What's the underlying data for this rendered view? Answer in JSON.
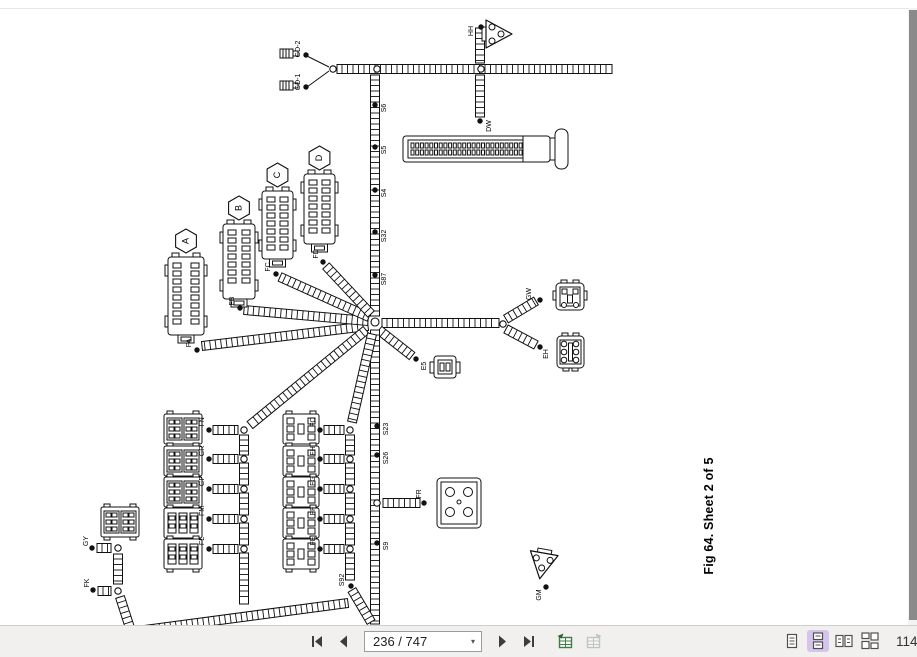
{
  "toolbar": {
    "page_value": "236 / 747",
    "zoom_value": "114",
    "nav_icons": [
      "first-page",
      "previous-page",
      "next-page",
      "last-page"
    ],
    "extra_icons": [
      "previous-view-table",
      "next-view-table"
    ],
    "view_icons": [
      "single-page",
      "continuous",
      "facing",
      "continuous-facing"
    ],
    "active_view": "continuous"
  },
  "diagram": {
    "caption": "Fig 64. Sheet 2 of 5",
    "colors": {
      "line": "#111111",
      "paper": "#ffffff",
      "toolbar_bg": "#f1f0ef",
      "highlight": "#d5c5ec",
      "scrollbar_thumb": "#8a8a8a",
      "icon_green": "#3f7d44"
    },
    "badges": [
      "A",
      "B",
      "C",
      "D"
    ],
    "connector_labels": [
      "HH",
      "DW",
      "GD-2",
      "GD-1",
      "S6",
      "S5",
      "S4",
      "S32",
      "S87",
      "FA",
      "FB",
      "FC",
      "FD",
      "GW",
      "EH",
      "E5",
      "S23",
      "S26",
      "FR",
      "S9",
      "S92",
      "FN",
      "GR",
      "GP",
      "FM",
      "FL",
      "FO",
      "FH",
      "FG",
      "FF",
      "FE",
      "GY",
      "FK",
      "GM"
    ],
    "ladders": [
      [
        337,
        69,
        612,
        69
      ],
      [
        480,
        28,
        480,
        63
      ],
      [
        480,
        75,
        480,
        117
      ],
      [
        375,
        75,
        375,
        316
      ],
      [
        368,
        326,
        202,
        346
      ],
      [
        368,
        321,
        244,
        310
      ],
      [
        369,
        317,
        280,
        277
      ],
      [
        371,
        314,
        326,
        266
      ],
      [
        382,
        323,
        499,
        323
      ],
      [
        506,
        319,
        536,
        301
      ],
      [
        506,
        329,
        536,
        345
      ],
      [
        379,
        330,
        412,
        356
      ],
      [
        375,
        330,
        375,
        624
      ],
      [
        383,
        503,
        420,
        503
      ],
      [
        366,
        330,
        250,
        425
      ],
      [
        372,
        334,
        352,
        422
      ],
      [
        244,
        435,
        244,
        455
      ],
      [
        244,
        463,
        244,
        485
      ],
      [
        244,
        493,
        244,
        515
      ],
      [
        244,
        523,
        244,
        545
      ],
      [
        244,
        553,
        244,
        604
      ],
      [
        350,
        435,
        350,
        455
      ],
      [
        350,
        463,
        350,
        485
      ],
      [
        350,
        493,
        350,
        515
      ],
      [
        350,
        523,
        350,
        545
      ],
      [
        350,
        553,
        350,
        580
      ],
      [
        352,
        590,
        371,
        622
      ],
      [
        213,
        430,
        238,
        430
      ],
      [
        213,
        459,
        238,
        459
      ],
      [
        213,
        489,
        238,
        489
      ],
      [
        213,
        519,
        238,
        519
      ],
      [
        213,
        549,
        238,
        549
      ],
      [
        324,
        430,
        344,
        430
      ],
      [
        324,
        459,
        344,
        459
      ],
      [
        324,
        489,
        344,
        489
      ],
      [
        324,
        519,
        344,
        519
      ],
      [
        324,
        549,
        344,
        549
      ],
      [
        97,
        548,
        111,
        548
      ],
      [
        118,
        554,
        118,
        584
      ],
      [
        98,
        591,
        111,
        591
      ],
      [
        120,
        597,
        130,
        628
      ],
      [
        122,
        633,
        348,
        603
      ]
    ],
    "lines": [
      [
        307,
        56,
        329,
        67
      ],
      [
        307,
        87,
        329,
        71
      ]
    ],
    "junctions": [
      [
        333,
        69
      ],
      [
        377,
        69
      ],
      [
        481,
        69
      ],
      [
        375,
        322,
        4
      ],
      [
        503,
        324
      ],
      [
        377,
        503
      ],
      [
        244,
        430
      ],
      [
        244,
        459
      ],
      [
        244,
        489
      ],
      [
        244,
        519
      ],
      [
        244,
        549
      ],
      [
        350,
        430
      ],
      [
        350,
        459
      ],
      [
        350,
        489
      ],
      [
        350,
        519
      ],
      [
        350,
        549
      ],
      [
        118,
        548
      ],
      [
        118,
        591
      ]
    ],
    "splices": [
      {
        "t": "HH",
        "x": 481,
        "y": 27,
        "lx": 471,
        "ly": 31
      },
      {
        "t": "DW",
        "x": 480,
        "y": 121,
        "lx": 489,
        "ly": 126
      },
      {
        "t": "S6",
        "x": 375,
        "y": 105,
        "lx": 384,
        "ly": 108
      },
      {
        "t": "S5",
        "x": 375,
        "y": 147,
        "lx": 384,
        "ly": 150
      },
      {
        "t": "S4",
        "x": 375,
        "y": 190,
        "lx": 384,
        "ly": 193
      },
      {
        "t": "S32",
        "x": 375,
        "y": 232,
        "lx": 384,
        "ly": 236
      },
      {
        "t": "S87",
        "x": 375,
        "y": 275,
        "lx": 384,
        "ly": 279
      },
      {
        "t": "S23",
        "x": 377,
        "y": 426,
        "lx": 386,
        "ly": 429
      },
      {
        "t": "S26",
        "x": 377,
        "y": 455,
        "lx": 386,
        "ly": 458
      },
      {
        "t": "S9",
        "x": 377,
        "y": 543,
        "lx": 386,
        "ly": 546
      },
      {
        "t": "S92",
        "x": 351,
        "y": 586,
        "lx": 342,
        "ly": 580
      },
      {
        "t": "FR",
        "x": 424,
        "y": 503,
        "lx": 419,
        "ly": 494
      },
      {
        "t": "E5",
        "x": 416,
        "y": 359,
        "lx": 424,
        "ly": 366
      },
      {
        "t": "GW",
        "x": 540,
        "y": 300,
        "lx": 529,
        "ly": 294
      },
      {
        "t": "EH",
        "x": 540,
        "y": 347,
        "lx": 546,
        "ly": 354
      },
      {
        "t": "GM",
        "x": 546,
        "y": 587,
        "lx": 539,
        "ly": 595
      },
      {
        "t": "FA",
        "x": 197,
        "y": 350,
        "lx": 189,
        "ly": 343
      },
      {
        "t": "FB",
        "x": 240,
        "y": 308,
        "lx": 232,
        "ly": 301
      },
      {
        "t": "FC",
        "x": 276,
        "y": 274,
        "lx": 268,
        "ly": 267
      },
      {
        "t": "FD",
        "x": 323,
        "y": 262,
        "lx": 316,
        "ly": 254
      },
      {
        "t": "FN",
        "x": 209,
        "y": 430,
        "lx": 202,
        "ly": 422
      },
      {
        "t": "GR",
        "x": 209,
        "y": 459,
        "lx": 202,
        "ly": 451
      },
      {
        "t": "GP",
        "x": 209,
        "y": 489,
        "lx": 202,
        "ly": 481
      },
      {
        "t": "FM",
        "x": 209,
        "y": 519,
        "lx": 202,
        "ly": 511
      },
      {
        "t": "FL",
        "x": 209,
        "y": 549,
        "lx": 202,
        "ly": 541
      },
      {
        "t": "FO",
        "x": 320,
        "y": 430,
        "lx": 313,
        "ly": 422
      },
      {
        "t": "FH",
        "x": 320,
        "y": 459,
        "lx": 313,
        "ly": 451
      },
      {
        "t": "FG",
        "x": 320,
        "y": 489,
        "lx": 313,
        "ly": 481
      },
      {
        "t": "FF",
        "x": 320,
        "y": 519,
        "lx": 313,
        "ly": 511
      },
      {
        "t": "FE",
        "x": 320,
        "y": 549,
        "lx": 313,
        "ly": 541
      },
      {
        "t": "GY",
        "x": 92,
        "y": 548,
        "lx": 86,
        "ly": 541
      },
      {
        "t": "FK",
        "x": 93,
        "y": 590,
        "lx": 87,
        "ly": 583
      },
      {
        "t": "GD-2",
        "x": 306,
        "y": 55,
        "lx": 298,
        "ly": 49
      },
      {
        "t": "GD-1",
        "x": 306,
        "y": 87,
        "lx": 298,
        "ly": 82
      }
    ],
    "connectors": [
      {
        "type": "tri",
        "x": 486,
        "y": 19,
        "rot": 0,
        "name": "connector-hh"
      },
      {
        "type": "tri",
        "x": 529,
        "y": 551,
        "rot": 100,
        "name": "connector-gm"
      },
      {
        "type": "bullet",
        "x": 280,
        "y": 49,
        "name": "connector-gd2"
      },
      {
        "type": "bullet",
        "x": 280,
        "y": 81,
        "name": "connector-gd1"
      },
      {
        "type": "bigconn",
        "x": 403,
        "y": 131,
        "name": "connector-dw"
      },
      {
        "type": "pinblock",
        "x": 168,
        "y": 257,
        "w": 36,
        "h": 78,
        "badge": "A",
        "name": "connector-a"
      },
      {
        "type": "pinblock",
        "x": 223,
        "y": 224,
        "w": 32,
        "h": 75,
        "badge": "B",
        "name": "connector-b"
      },
      {
        "type": "pinblock",
        "x": 262,
        "y": 191,
        "w": 31,
        "h": 68,
        "badge": "C",
        "name": "connector-c"
      },
      {
        "type": "pinblock",
        "x": 304,
        "y": 174,
        "w": 31,
        "h": 70,
        "badge": "D",
        "name": "connector-d"
      },
      {
        "type": "gw",
        "x": 556,
        "y": 283,
        "name": "connector-gw"
      },
      {
        "type": "eh",
        "x": 557,
        "y": 336,
        "name": "connector-eh"
      },
      {
        "type": "e5",
        "x": 434,
        "y": 356,
        "name": "connector-e5"
      },
      {
        "type": "fr",
        "x": 437,
        "y": 478,
        "name": "connector-fr"
      },
      {
        "type": "relay2",
        "x": 164,
        "y": 414,
        "name": "relay-fn"
      },
      {
        "type": "relay2",
        "x": 164,
        "y": 446,
        "name": "relay-gr"
      },
      {
        "type": "relay2",
        "x": 164,
        "y": 477,
        "name": "relay-gp"
      },
      {
        "type": "relay3",
        "x": 164,
        "y": 508,
        "name": "relay-fm"
      },
      {
        "type": "relay3",
        "x": 164,
        "y": 539,
        "name": "relay-fl"
      },
      {
        "type": "relayr",
        "x": 283,
        "y": 414,
        "name": "relay-fo"
      },
      {
        "type": "relayr",
        "x": 283,
        "y": 446,
        "name": "relay-fh"
      },
      {
        "type": "relayr",
        "x": 283,
        "y": 477,
        "name": "relay-fg"
      },
      {
        "type": "relayr",
        "x": 283,
        "y": 508,
        "name": "relay-ff"
      },
      {
        "type": "relayr",
        "x": 283,
        "y": 539,
        "name": "relay-fe"
      },
      {
        "type": "relay2",
        "x": 101,
        "y": 507,
        "name": "relay-gy"
      }
    ]
  }
}
